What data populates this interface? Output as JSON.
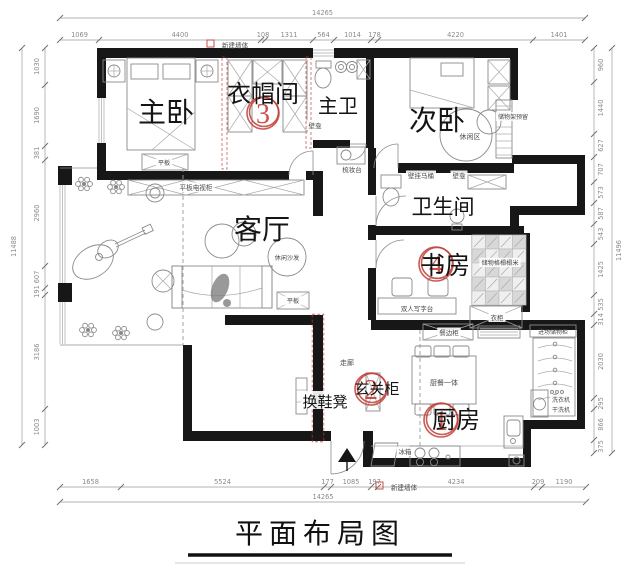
{
  "title": "平面布局图",
  "legend": {
    "new_wall_top": "新建墙体",
    "new_wall_bottom": "新建墙体"
  },
  "dimensions": {
    "top": {
      "total": "14265",
      "segments": [
        "1069",
        "4400",
        "108",
        "1311",
        "564",
        "1014",
        "178",
        "4220",
        "1401"
      ]
    },
    "bottom": {
      "total": "14265",
      "segments": [
        "1658",
        "5524",
        "177",
        "1085",
        "197",
        "4234",
        "209",
        "1190"
      ]
    },
    "left": {
      "total": "11488",
      "segments": [
        "1030",
        "1690",
        "381",
        "2960",
        "607",
        "191",
        "3186",
        "1003"
      ]
    },
    "right": {
      "total": "11496",
      "segments": [
        "960",
        "1440",
        "627",
        "707",
        "573",
        "587",
        "543",
        "1425",
        "535",
        "314",
        "2030",
        "295",
        "866",
        "375"
      ]
    }
  },
  "rooms": {
    "master": "主卧",
    "cloak": "衣帽间",
    "mbath": "主卫",
    "second": "次卧",
    "living": "客厅",
    "bath": "卫生间",
    "study": "书房",
    "kitchen": "厨房"
  },
  "badges": {
    "cloak": "3",
    "study": "4",
    "entry": "2",
    "kitchen": "1"
  },
  "labels": {
    "tv_cabinet": "平板电视柜",
    "leisure_sofa": "休闲沙发",
    "flat_cabinet_bedroom": "平板",
    "flat_cabinet_living": "平板",
    "vanity": "梳妆台",
    "niche_hall": "壁龛",
    "wall_toilet": "壁挂马桶",
    "niche_bath": "壁龛",
    "leisure_area": "休闲区",
    "storage_reserved": "储物架预留",
    "desk": "双人写字台",
    "tatami": "储物格榻榻米",
    "wardrobe": "衣柜",
    "sideboard": "餐边柜",
    "dining_table": "厨餐一体",
    "fridge": "冰箱",
    "corridor": "走廊",
    "bench": "换鞋凳",
    "entry_cabinet": "玄关柜",
    "washer": "洗衣机",
    "dryer": "干洗机",
    "entry_storage": "进场储物柜"
  }
}
